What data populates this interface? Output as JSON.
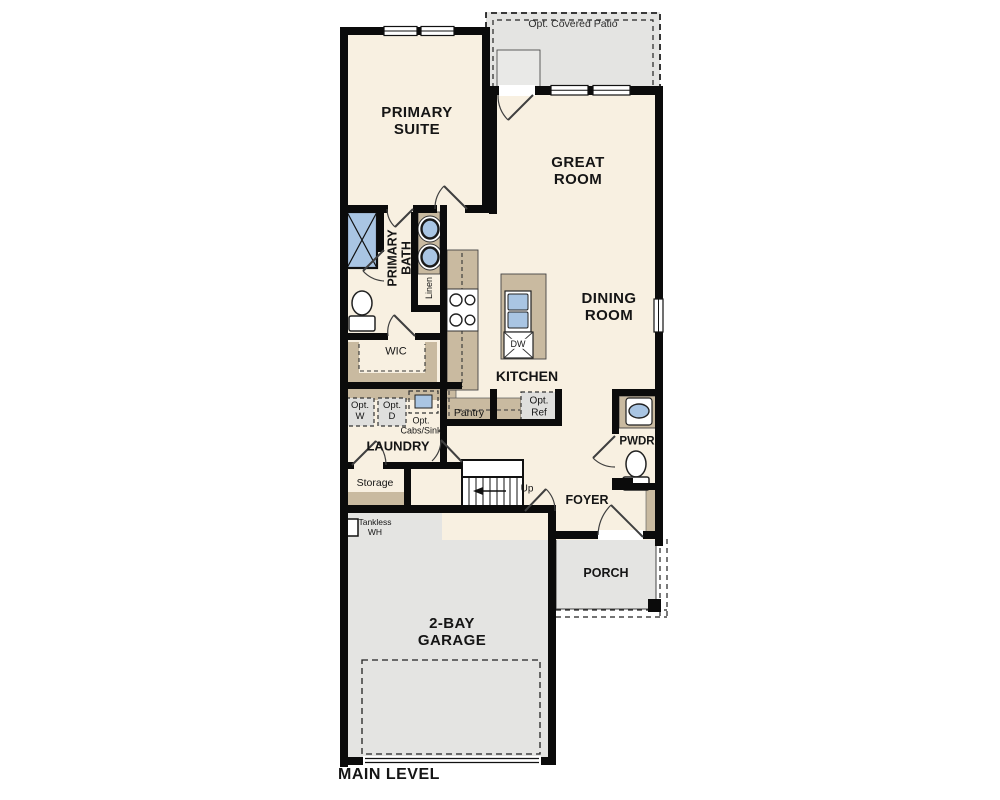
{
  "plan": {
    "labels": {
      "patio": "Opt. Covered Patio",
      "primary_suite": "PRIMARY\nSUITE",
      "great_room": "GREAT\nROOM",
      "dining_room": "DINING\nROOM",
      "primary_bath": "PRIMARY\nBATH",
      "linen": "Linen",
      "wic": "WIC",
      "kitchen": "KITCHEN",
      "dw": "DW",
      "pantry": "Pantry",
      "opt_ref": "Opt.\nRef",
      "opt_w": "Opt.\nW",
      "opt_d": "Opt.\nD",
      "opt_cabs_sink": "Opt.\nCabs/Sink",
      "laundry": "LAUNDRY",
      "storage": "Storage",
      "tankless_wh": "Tankless\nWH",
      "up": "Up",
      "foyer": "FOYER",
      "pwdr": "PWDR",
      "porch": "PORCH",
      "garage": "2-BAY\nGARAGE",
      "main_level": "MAIN LEVEL"
    },
    "colors": {
      "floor": "#f8f0e1",
      "exterior_concrete": "#e4e4e2",
      "casework": "#c9baa0",
      "fixture_blue": "#a9c5e3",
      "wall": "#0b0b0b"
    }
  }
}
